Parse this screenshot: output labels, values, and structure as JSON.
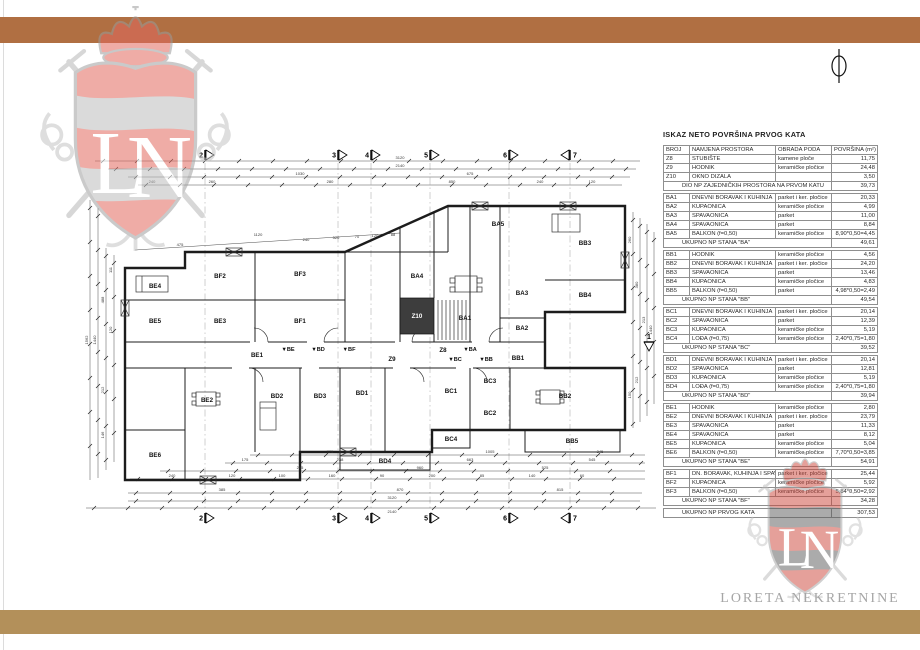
{
  "branding": {
    "company": "LORETA NEKRETNINE",
    "monogram": "LN",
    "colors": {
      "bar_top": "#b06f42",
      "bar_bottom": "#b3905a",
      "crest_red": "#d94f43",
      "crest_gray": "#bdbdbd",
      "company_text": "#a6a6a6"
    }
  },
  "table": {
    "title": "ISKAZ NETO POVRŠINA PRVOG KATA",
    "headers": [
      "BROJ",
      "NAMJENA PROSTORA",
      "OBRADA PODA",
      "POVRŠINA (m²)"
    ],
    "groups": [
      {
        "rows": [
          [
            "Z8",
            "STUBIŠTE",
            "kamene ploče",
            "11,75"
          ],
          [
            "Z9",
            "HODNIK",
            "keramičke pločice",
            "24,48"
          ],
          [
            "Z10",
            "OKNO DIZALA",
            "",
            "3,50"
          ]
        ],
        "summary": {
          "label": "DIO NP ZAJEDNIČKIH PROSTORA NA PRVOM KATU",
          "value": "39,73"
        }
      },
      {
        "rows": [
          [
            "BA1",
            "DNEVNI BORAVAK I KUHINJA",
            "parket i ker. pločice",
            "20,33"
          ],
          [
            "BA2",
            "KUPAONICA",
            "keramičke pločice",
            "4,99"
          ],
          [
            "BA3",
            "SPAVAONICA",
            "parket",
            "11,00"
          ],
          [
            "BA4",
            "SPAVAONICA",
            "parket",
            "8,84"
          ],
          [
            "BA5",
            "BALKON (f=0,50)",
            "keramičke pločice",
            "8,90*0,50=4,45"
          ]
        ],
        "summary": {
          "label": "UKUPNO NP STANA \"BA\"",
          "value": "49,61"
        }
      },
      {
        "rows": [
          [
            "BB1",
            "HODNIK",
            "keramičke pločice",
            "4,56"
          ],
          [
            "BB2",
            "DNEVNI BORAVAK I KUHINJA",
            "parket i ker. pločice",
            "24,20"
          ],
          [
            "BB3",
            "SPAVAONICA",
            "parket",
            "13,46"
          ],
          [
            "BB4",
            "KUPAONICA",
            "keramičke pločice",
            "4,83"
          ],
          [
            "BB5",
            "BALKON (f=0,50)",
            "parket",
            "4,98*0,50=2,49"
          ]
        ],
        "summary": {
          "label": "UKUPNO NP STANA \"BB\"",
          "value": "49,54"
        }
      },
      {
        "rows": [
          [
            "BC1",
            "DNEVNI BORAVAK I KUHINJA",
            "parket i ker. pločice",
            "20,14"
          ],
          [
            "BC2",
            "SPAVAONICA",
            "parket",
            "12,39"
          ],
          [
            "BC3",
            "KUPAONICA",
            "keramičke pločice",
            "5,19"
          ],
          [
            "BC4",
            "LOĐA (f=0,75)",
            "keramičke pločice",
            "2,40*0,75=1,80"
          ]
        ],
        "summary": {
          "label": "UKUPNO NP STANA \"BC\"",
          "value": "39,52"
        }
      },
      {
        "rows": [
          [
            "BD1",
            "DNEVNI BORAVAK I KUHINJA",
            "parket i ker. pločice",
            "20,14"
          ],
          [
            "BD2",
            "SPAVAONICA",
            "parket",
            "12,81"
          ],
          [
            "BD3",
            "KUPAONICA",
            "keramičke pločice",
            "5,19"
          ],
          [
            "BD4",
            "LOĐA (f=0,75)",
            "keramičke pločice",
            "2,40*0,75=1,80"
          ]
        ],
        "summary": {
          "label": "UKUPNO NP STANA \"BD\"",
          "value": "39,94"
        }
      },
      {
        "rows": [
          [
            "BE1",
            "HODNIK",
            "keramičke pločice",
            "2,80"
          ],
          [
            "BE2",
            "DNEVNI BORAVAK I KUHINJA",
            "parket i ker. pločice",
            "23,79"
          ],
          [
            "BE3",
            "SPAVAONICA",
            "parket",
            "11,33"
          ],
          [
            "BE4",
            "SPAVAONICA",
            "parket",
            "8,12"
          ],
          [
            "BE5",
            "KUPAONICA",
            "keramičke pločice",
            "5,04"
          ],
          [
            "BE6",
            "BALKON (f=0,50)",
            "keramičke pločice",
            "7,70*0,50=3,85"
          ]
        ],
        "summary": {
          "label": "UKUPNO NP STANA \"BE\"",
          "value": "54,91"
        }
      },
      {
        "rows": [
          [
            "BF1",
            "DN. BORAVAK, KUHINJA I SPAVAONICA",
            "parket i ker. pločice",
            "25,44"
          ],
          [
            "BF2",
            "KUPAONICA",
            "keramičke pločice",
            "5,92"
          ],
          [
            "BF3",
            "BALKON (f=0,50)",
            "keramičke pločice",
            "5,84*0,50=2,92"
          ]
        ],
        "summary": {
          "label": "UKUPNO NP STANA \"BF\"",
          "value": "34,28"
        }
      }
    ],
    "total": {
      "label": "UKUPNO NP PRVOG KATA",
      "value": "307,53"
    }
  },
  "plan": {
    "grid_markers": [
      {
        "label": "2",
        "x": 205
      },
      {
        "label": "3",
        "x": 338
      },
      {
        "label": "4",
        "x": 371
      },
      {
        "label": "5",
        "x": 430
      },
      {
        "label": "6",
        "x": 509
      },
      {
        "label": "7",
        "x": 570,
        "flip": true
      }
    ],
    "grid_marker_right": {
      "label": "1",
      "x": 649,
      "y": 342
    },
    "room_labels": [
      {
        "id": "BE4",
        "x": 155,
        "y": 288
      },
      {
        "id": "BE5",
        "x": 155,
        "y": 323
      },
      {
        "id": "BE3",
        "x": 220,
        "y": 323
      },
      {
        "id": "BF2",
        "x": 220,
        "y": 278
      },
      {
        "id": "BF3",
        "x": 300,
        "y": 276
      },
      {
        "id": "BF1",
        "x": 300,
        "y": 323
      },
      {
        "id": "BA5",
        "x": 498,
        "y": 226
      },
      {
        "id": "BA4",
        "x": 417,
        "y": 278
      },
      {
        "id": "BA1",
        "x": 465,
        "y": 320
      },
      {
        "id": "BA3",
        "x": 522,
        "y": 295
      },
      {
        "id": "BA2",
        "x": 522,
        "y": 330
      },
      {
        "id": "Z10",
        "x": 417,
        "y": 318
      },
      {
        "id": "Z8",
        "x": 443,
        "y": 352
      },
      {
        "id": "Z9",
        "x": 392,
        "y": 361
      },
      {
        "id": "BB3",
        "x": 585,
        "y": 245
      },
      {
        "id": "BB4",
        "x": 585,
        "y": 297
      },
      {
        "id": "BB1",
        "x": 518,
        "y": 360
      },
      {
        "id": "BB2",
        "x": 565,
        "y": 398
      },
      {
        "id": "BB5",
        "x": 572,
        "y": 443
      },
      {
        "id": "BE1",
        "x": 257,
        "y": 357
      },
      {
        "id": "BE2",
        "x": 207,
        "y": 402
      },
      {
        "id": "BE6",
        "x": 155,
        "y": 457
      },
      {
        "id": "BD2",
        "x": 277,
        "y": 398
      },
      {
        "id": "BD3",
        "x": 320,
        "y": 398
      },
      {
        "id": "BD1",
        "x": 362,
        "y": 395
      },
      {
        "id": "BD4",
        "x": 385,
        "y": 463
      },
      {
        "id": "BC1",
        "x": 451,
        "y": 393
      },
      {
        "id": "BC3",
        "x": 490,
        "y": 383
      },
      {
        "id": "BC2",
        "x": 490,
        "y": 415
      },
      {
        "id": "BC4",
        "x": 451,
        "y": 441
      }
    ],
    "unit_labels": [
      {
        "id": "BE",
        "x": 288,
        "y": 351
      },
      {
        "id": "BD",
        "x": 318,
        "y": 351
      },
      {
        "id": "BF",
        "x": 349,
        "y": 351
      },
      {
        "id": "BA",
        "x": 470,
        "y": 351
      },
      {
        "id": "BC",
        "x": 455,
        "y": 361
      },
      {
        "id": "BB",
        "x": 486,
        "y": 361
      }
    ],
    "dimension_labels": [
      {
        "t": "3120",
        "x": 400,
        "y": 159
      },
      {
        "t": "2140",
        "x": 400,
        "y": 167
      },
      {
        "t": "1030",
        "x": 300,
        "y": 175
      },
      {
        "t": "675",
        "x": 470,
        "y": 175
      },
      {
        "t": "240",
        "x": 152,
        "y": 183
      },
      {
        "t": "260",
        "x": 212,
        "y": 183
      },
      {
        "t": "280",
        "x": 330,
        "y": 183
      },
      {
        "t": "850",
        "x": 452,
        "y": 183
      },
      {
        "t": "240",
        "x": 540,
        "y": 183
      },
      {
        "t": "120",
        "x": 592,
        "y": 183
      },
      {
        "t": "475",
        "x": 180,
        "y": 246
      },
      {
        "t": "1120",
        "x": 258,
        "y": 236
      },
      {
        "t": "240",
        "x": 306,
        "y": 241
      },
      {
        "t": "520",
        "x": 336,
        "y": 239
      },
      {
        "t": "70",
        "x": 357,
        "y": 238
      },
      {
        "t": "120",
        "x": 375,
        "y": 237
      },
      {
        "t": "88",
        "x": 393,
        "y": 236
      },
      {
        "t": "775",
        "x": 330,
        "y": 453
      },
      {
        "t": "1005",
        "x": 490,
        "y": 453
      },
      {
        "t": "345",
        "x": 600,
        "y": 453
      },
      {
        "t": "175",
        "x": 245,
        "y": 461
      },
      {
        "t": "238",
        "x": 340,
        "y": 461
      },
      {
        "t": "663",
        "x": 470,
        "y": 461
      },
      {
        "t": "545",
        "x": 592,
        "y": 461
      },
      {
        "t": "295",
        "x": 300,
        "y": 469
      },
      {
        "t": "960",
        "x": 420,
        "y": 469
      },
      {
        "t": "525",
        "x": 545,
        "y": 469
      },
      {
        "t": "240",
        "x": 172,
        "y": 477
      },
      {
        "t": "120",
        "x": 232,
        "y": 477
      },
      {
        "t": "100",
        "x": 282,
        "y": 477
      },
      {
        "t": "160",
        "x": 332,
        "y": 477
      },
      {
        "t": "90",
        "x": 382,
        "y": 477
      },
      {
        "t": "200",
        "x": 432,
        "y": 477
      },
      {
        "t": "85",
        "x": 482,
        "y": 477
      },
      {
        "t": "140",
        "x": 532,
        "y": 477
      },
      {
        "t": "60",
        "x": 582,
        "y": 477
      },
      {
        "t": "385",
        "x": 222,
        "y": 491
      },
      {
        "t": "870",
        "x": 400,
        "y": 491
      },
      {
        "t": "815",
        "x": 560,
        "y": 491
      },
      {
        "t": "3120",
        "x": 392,
        "y": 499
      },
      {
        "t": "2140",
        "x": 392,
        "y": 513
      },
      {
        "t": "1562",
        "x": 88,
        "y": 340,
        "v": 1
      },
      {
        "t": "1440",
        "x": 96,
        "y": 340,
        "v": 1
      },
      {
        "t": "488",
        "x": 104,
        "y": 300,
        "v": 1
      },
      {
        "t": "212",
        "x": 104,
        "y": 390,
        "v": 1
      },
      {
        "t": "146",
        "x": 104,
        "y": 435,
        "v": 1
      },
      {
        "t": "111",
        "x": 112,
        "y": 270,
        "v": 1
      },
      {
        "t": "120",
        "x": 112,
        "y": 330,
        "v": 1
      },
      {
        "t": "260",
        "x": 631,
        "y": 240,
        "v": 1
      },
      {
        "t": "380",
        "x": 638,
        "y": 285,
        "v": 1
      },
      {
        "t": "213",
        "x": 645,
        "y": 320,
        "v": 1
      },
      {
        "t": "1440",
        "x": 652,
        "y": 330,
        "v": 1
      },
      {
        "t": "212",
        "x": 638,
        "y": 380,
        "v": 1
      },
      {
        "t": "150",
        "x": 631,
        "y": 395,
        "v": 1
      }
    ]
  }
}
